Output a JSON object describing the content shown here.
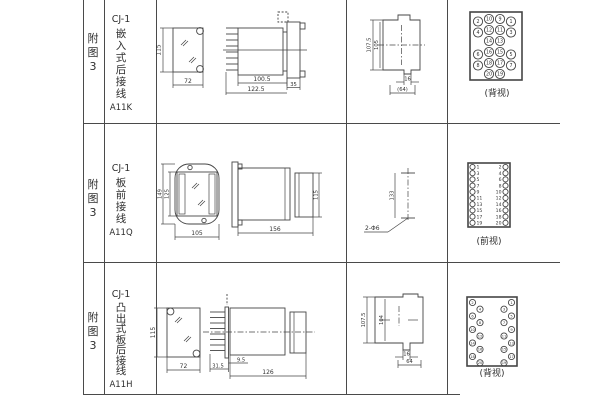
{
  "page": {
    "background": "#ffffff",
    "line_color": "#4a4a4a"
  },
  "rows": [
    {
      "fig": "附图3",
      "model": "CJ-1",
      "type_name": "嵌入式后接线",
      "code": "A11K",
      "view_label": "(背视)",
      "dims": {
        "cutout_h": "115",
        "cutout_w": "72",
        "body_len": "100.5",
        "total_len": "122.5",
        "flange_w": "35",
        "panel_h": "107.5",
        "panel_inner_h": "105",
        "tab_w": "16",
        "overall_w": "(64)"
      },
      "terminals": {
        "rows": [
          [
            "2",
            "10",
            "9",
            "1"
          ],
          [
            "4",
            "12",
            "11",
            "3"
          ],
          [
            "",
            "14",
            "13",
            ""
          ],
          [
            "6",
            "16",
            "15",
            "5"
          ],
          [
            "8",
            "18",
            "17",
            "7"
          ],
          [
            "",
            "20",
            "19",
            ""
          ]
        ]
      }
    },
    {
      "fig": "附图3",
      "model": "CJ-1",
      "type_name": "板前接线",
      "code": "A11Q",
      "view_label": "(前视)",
      "dims": {
        "outer_h": "149",
        "inner_h": "125",
        "width": "105",
        "body_len": "156",
        "body_h": "115",
        "hole_dist": "133",
        "hole_spec": "2-Φ6"
      },
      "terminals": {
        "left": [
          "1",
          "3",
          "5",
          "7",
          "9",
          "11",
          "13",
          "15",
          "17",
          "19"
        ],
        "right": [
          "2",
          "4",
          "6",
          "8",
          "10",
          "12",
          "14",
          "16",
          "18",
          "20"
        ]
      }
    },
    {
      "fig": "附图3",
      "model": "CJ-1",
      "type_name": "凸出式板后接线",
      "code": "A11H",
      "view_label": "(背视)",
      "dims": {
        "cutout_h": "115",
        "cutout_w": "72",
        "stud_len": "31.5",
        "board_off": "9.5",
        "body_len": "126",
        "panel_h": "107.5",
        "panel_inner_h": "104",
        "tab_w": "16",
        "overall_w": "64"
      },
      "terminals": {
        "left_outer": [
          "2",
          "6",
          "10",
          "14",
          "18"
        ],
        "left_inner": [
          "4",
          "8",
          "12",
          "16",
          "20"
        ],
        "right_inner": [
          "3",
          "7",
          "11",
          "15",
          "19"
        ],
        "right_outer": [
          "1",
          "5",
          "9",
          "13",
          "17"
        ]
      }
    }
  ]
}
